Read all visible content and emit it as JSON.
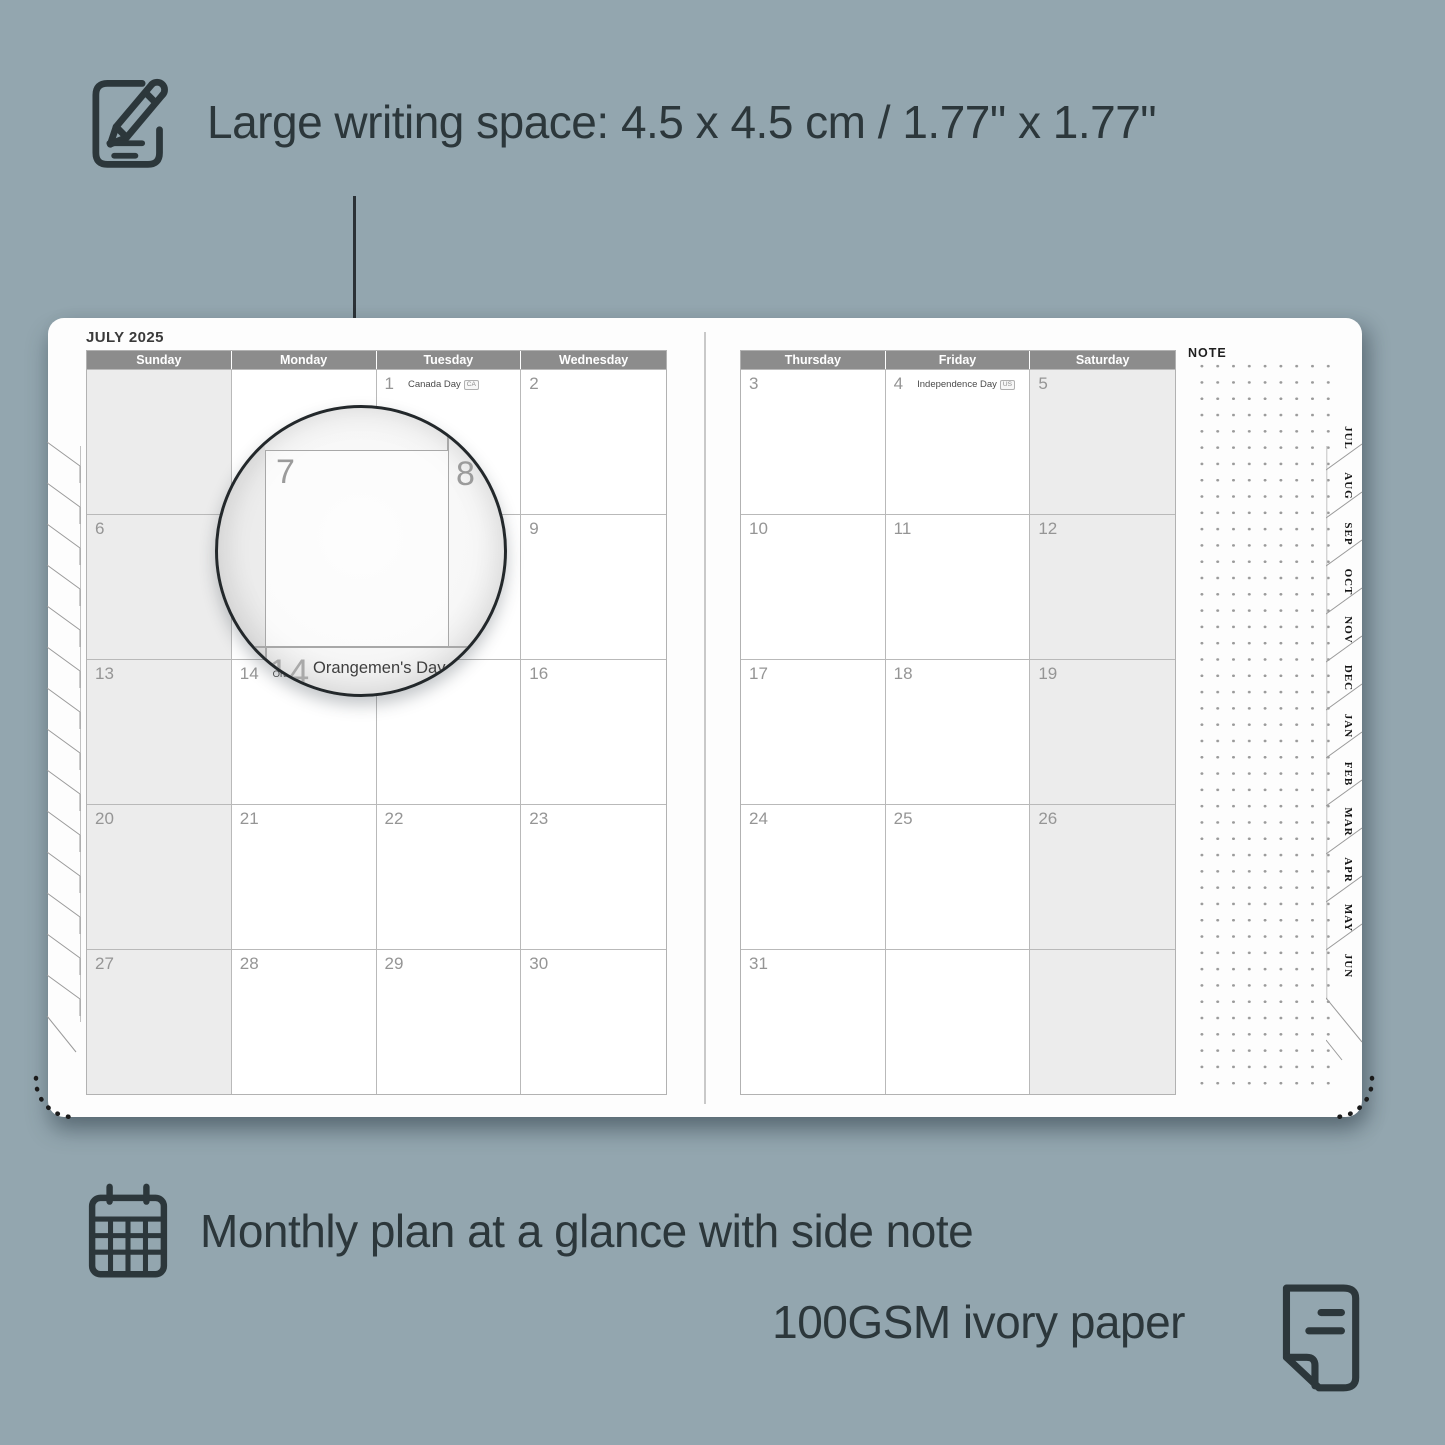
{
  "colors": {
    "background": "#93a6af",
    "ink": "#2c373b",
    "page": "#fdfdfd",
    "header_bar": "#8c8c8c",
    "weekend_shade": "#ececec",
    "grid_line": "#b9b9b9",
    "day_number": "#959595"
  },
  "annotations": {
    "top": "Large writing space: 4.5 x 4.5 cm / 1.77\" x 1.77\"",
    "bottom_line1": "Monthly plan at a glance with side note",
    "bottom_line2": "100GSM ivory paper"
  },
  "planner": {
    "month_title": "JULY 2025",
    "note_label": "NOTE",
    "left_page": {
      "headers": [
        "Sunday",
        "Monday",
        "Tuesday",
        "Wednesday"
      ],
      "rows": [
        [
          {
            "day": ""
          },
          {
            "day": ""
          },
          {
            "day": "1",
            "holiday": "Canada Day",
            "badge": "CA"
          },
          {
            "day": "2"
          }
        ],
        [
          {
            "day": "6"
          },
          {
            "day": "7"
          },
          {
            "day": "8"
          },
          {
            "day": "9"
          }
        ],
        [
          {
            "day": "13"
          },
          {
            "day": "14",
            "holiday": "Orangemen's Day (n.i.)",
            "badge": "UK"
          },
          {
            "day": "15"
          },
          {
            "day": "16"
          }
        ],
        [
          {
            "day": "20"
          },
          {
            "day": "21"
          },
          {
            "day": "22"
          },
          {
            "day": "23"
          }
        ],
        [
          {
            "day": "27"
          },
          {
            "day": "28"
          },
          {
            "day": "29"
          },
          {
            "day": "30"
          }
        ]
      ]
    },
    "right_page": {
      "headers": [
        "Thursday",
        "Friday",
        "Saturday"
      ],
      "rows": [
        [
          {
            "day": "3"
          },
          {
            "day": "4",
            "holiday": "Independence Day",
            "badge": "US"
          },
          {
            "day": "5"
          }
        ],
        [
          {
            "day": "10"
          },
          {
            "day": "11"
          },
          {
            "day": "12"
          }
        ],
        [
          {
            "day": "17"
          },
          {
            "day": "18"
          },
          {
            "day": "19"
          }
        ],
        [
          {
            "day": "24"
          },
          {
            "day": "25"
          },
          {
            "day": "26"
          }
        ],
        [
          {
            "day": "31"
          },
          {
            "day": ""
          },
          {
            "day": ""
          }
        ]
      ]
    },
    "month_tabs": [
      "JUL",
      "AUG",
      "SEP",
      "OCT",
      "NOV",
      "DEC",
      "JAN",
      "FEB",
      "MAR",
      "APR",
      "MAY",
      "JUN"
    ],
    "magnifier": {
      "day_left": "7",
      "day_right": "8",
      "day_bottom": "14",
      "holiday": "Orangemen's Day (n.i.)",
      "badge": "UK"
    }
  }
}
